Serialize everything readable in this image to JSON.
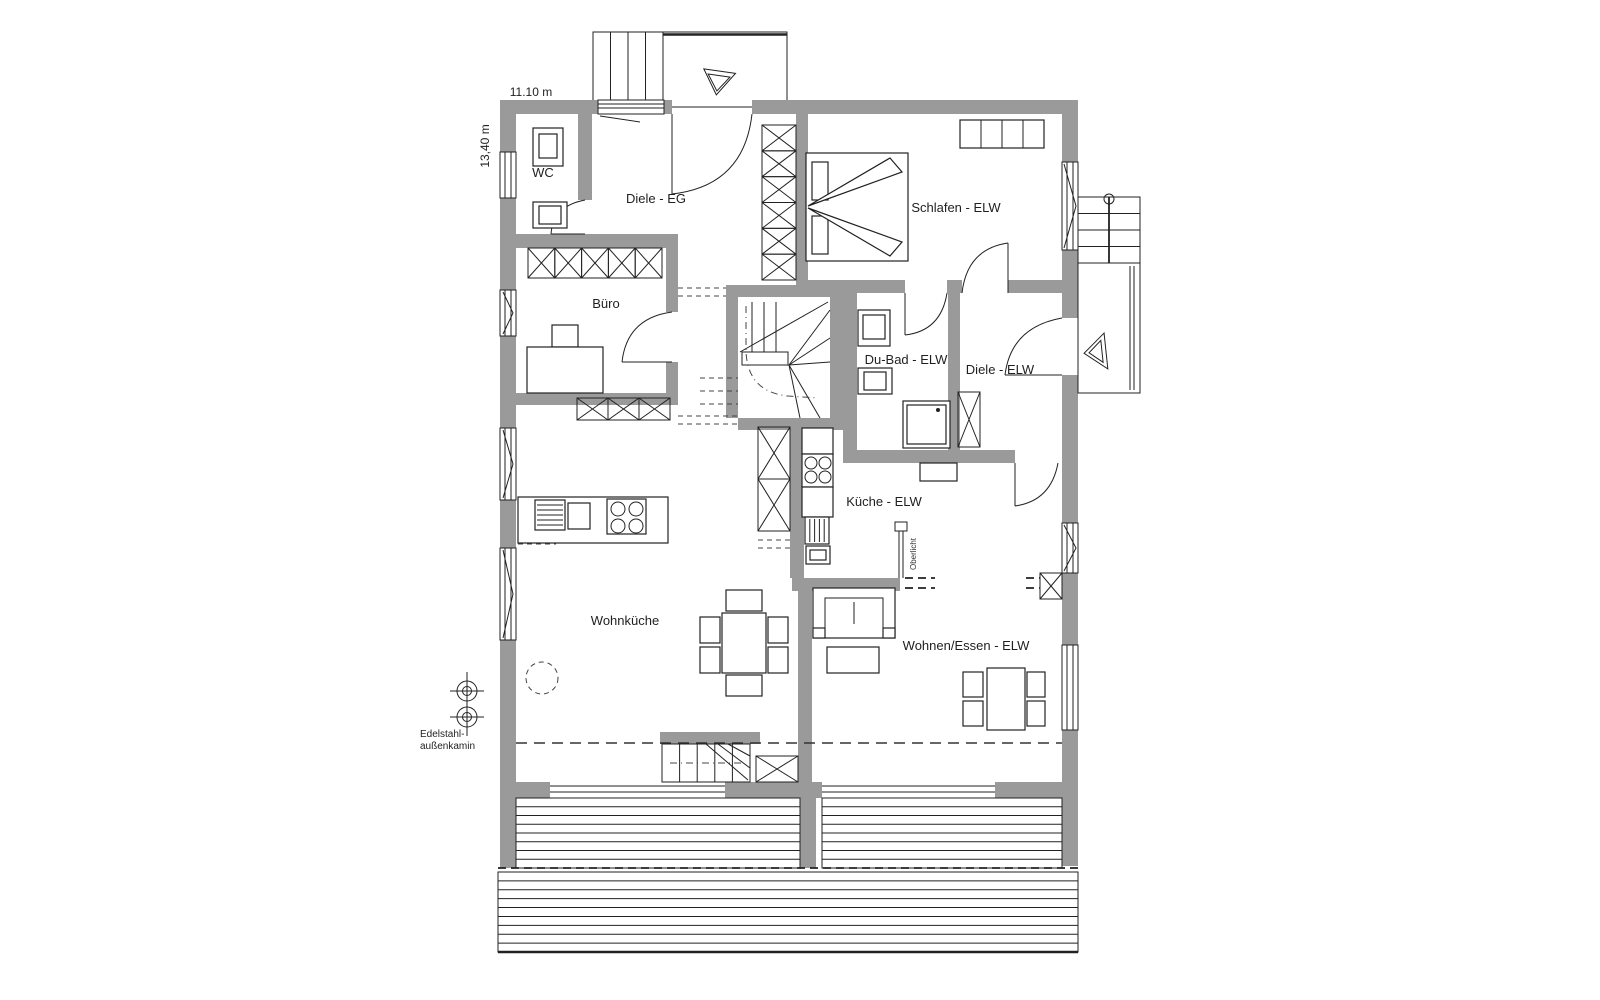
{
  "dimensions": {
    "width_label": "11.10 m",
    "depth_label": "13,40 m"
  },
  "rooms": [
    {
      "id": "wc",
      "label": "WC"
    },
    {
      "id": "diele-eg",
      "label": "Diele - EG"
    },
    {
      "id": "schlafen-elw",
      "label": "Schlafen - ELW"
    },
    {
      "id": "buero",
      "label": "Büro"
    },
    {
      "id": "du-bad-elw",
      "label": "Du-Bad - ELW"
    },
    {
      "id": "diele-elw",
      "label": "Diele - ELW"
    },
    {
      "id": "kueche-elw",
      "label": "Küche - ELW"
    },
    {
      "id": "wohnkueche",
      "label": "Wohnküche"
    },
    {
      "id": "wohnen-essen-elw",
      "label": "Wohnen/Essen - ELW"
    }
  ],
  "annotations": {
    "oberlicht": "Oberlicht",
    "chimney_line1": "Edelstahl-",
    "chimney_line2": "außenkamin"
  },
  "colors": {
    "wall": "#9a9a9a",
    "line": "#222222"
  }
}
